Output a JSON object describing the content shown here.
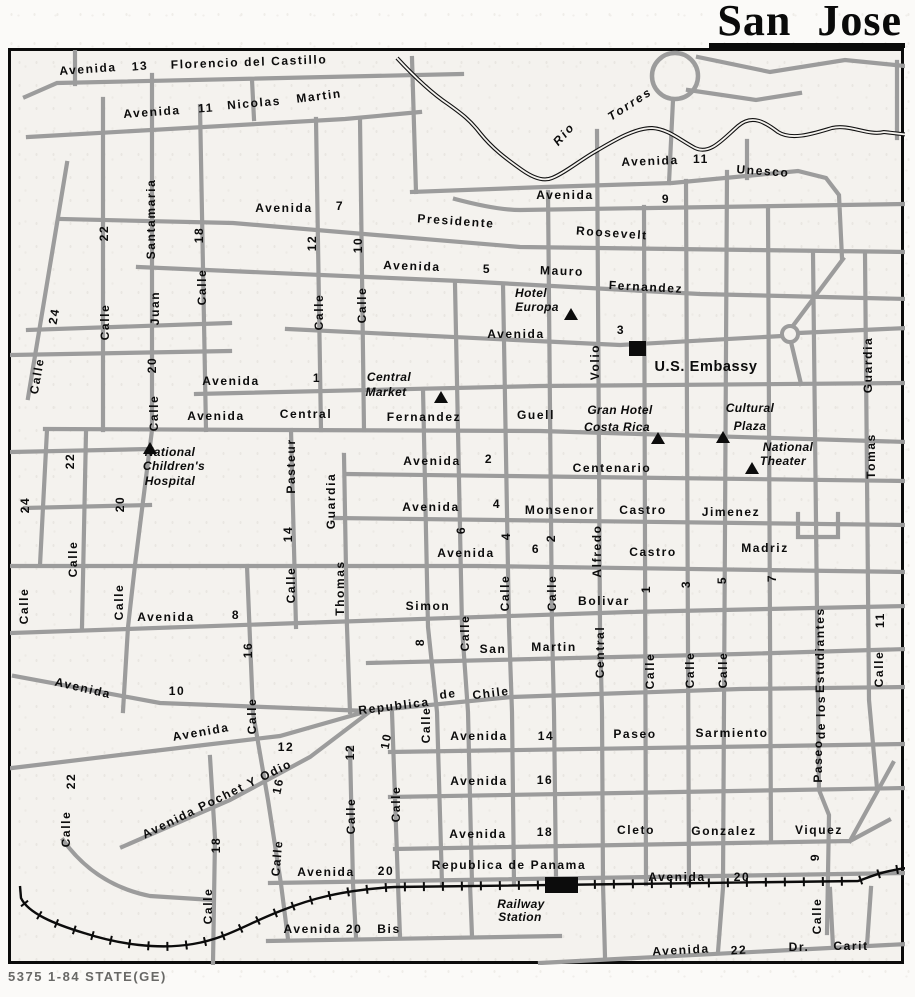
{
  "title": "San Jose",
  "caption": "5375 1-84 STATE(GE)",
  "colors": {
    "road": "#9c9c9c",
    "paper": "#f4f2ee",
    "ink": "#0c0c0c"
  },
  "map": {
    "labels": [
      {
        "t": "Avenida",
        "x": 88,
        "y": 69,
        "r": -4
      },
      {
        "t": "13",
        "x": 140,
        "y": 66,
        "r": -4
      },
      {
        "t": "Florencio del Castillo",
        "x": 249,
        "y": 62,
        "r": -2
      },
      {
        "t": "Avenida",
        "x": 152,
        "y": 112,
        "r": -4
      },
      {
        "t": "11",
        "x": 206,
        "y": 108,
        "r": -4
      },
      {
        "t": "Nicolas",
        "x": 254,
        "y": 103,
        "r": -5
      },
      {
        "t": "Martin",
        "x": 319,
        "y": 96,
        "r": -7
      },
      {
        "t": "Avenida",
        "x": 284,
        "y": 208
      },
      {
        "t": "7",
        "x": 340,
        "y": 206
      },
      {
        "t": "Presidente",
        "x": 456,
        "y": 221,
        "r": 4
      },
      {
        "t": "Roosevelt",
        "x": 612,
        "y": 233,
        "r": 4
      },
      {
        "t": "Avenida",
        "x": 412,
        "y": 266,
        "r": 2
      },
      {
        "t": "5",
        "x": 487,
        "y": 269
      },
      {
        "t": "Mauro",
        "x": 562,
        "y": 271,
        "r": 2
      },
      {
        "t": "Fernandez",
        "x": 646,
        "y": 287,
        "r": 3
      },
      {
        "t": "Avenida",
        "x": 516,
        "y": 334
      },
      {
        "t": "3",
        "x": 621,
        "y": 330
      },
      {
        "t": "Avenida",
        "x": 565,
        "y": 195
      },
      {
        "t": "9",
        "x": 666,
        "y": 199
      },
      {
        "t": "Avenida",
        "x": 650,
        "y": 161,
        "r": -2
      },
      {
        "t": "11",
        "x": 701,
        "y": 159
      },
      {
        "t": "Unesco",
        "x": 763,
        "y": 171,
        "r": 4
      },
      {
        "t": "U.S. Embassy",
        "x": 706,
        "y": 367,
        "k": "emb"
      },
      {
        "t": "Avenida",
        "x": 231,
        "y": 381
      },
      {
        "t": "1",
        "x": 317,
        "y": 378
      },
      {
        "t": "Avenida",
        "x": 216,
        "y": 416
      },
      {
        "t": "Central",
        "x": 306,
        "y": 414
      },
      {
        "t": "Fernandez",
        "x": 424,
        "y": 417
      },
      {
        "t": "Guell",
        "x": 536,
        "y": 415
      },
      {
        "t": "Avenida",
        "x": 432,
        "y": 461
      },
      {
        "t": "2",
        "x": 489,
        "y": 459
      },
      {
        "t": "Centenario",
        "x": 612,
        "y": 468
      },
      {
        "t": "Avenida",
        "x": 431,
        "y": 507
      },
      {
        "t": "4",
        "x": 497,
        "y": 504
      },
      {
        "t": "Monsenor",
        "x": 560,
        "y": 510
      },
      {
        "t": "Castro",
        "x": 643,
        "y": 510
      },
      {
        "t": "Jimenez",
        "x": 731,
        "y": 512
      },
      {
        "t": "Avenida",
        "x": 466,
        "y": 553
      },
      {
        "t": "6",
        "x": 536,
        "y": 549
      },
      {
        "t": "Castro",
        "x": 653,
        "y": 552
      },
      {
        "t": "Madriz",
        "x": 765,
        "y": 548
      },
      {
        "t": "Avenida",
        "x": 166,
        "y": 617
      },
      {
        "t": "8",
        "x": 236,
        "y": 615
      },
      {
        "t": "Simon",
        "x": 428,
        "y": 606
      },
      {
        "t": "Bolivar",
        "x": 604,
        "y": 601
      },
      {
        "t": "San",
        "x": 493,
        "y": 649
      },
      {
        "t": "Martin",
        "x": 554,
        "y": 647
      },
      {
        "t": "Avenida",
        "x": 83,
        "y": 688,
        "r": 13
      },
      {
        "t": "10",
        "x": 177,
        "y": 691
      },
      {
        "t": "Republica",
        "x": 394,
        "y": 706,
        "r": -7
      },
      {
        "t": "de",
        "x": 448,
        "y": 694,
        "r": -7
      },
      {
        "t": "Chile",
        "x": 491,
        "y": 693,
        "r": -7
      },
      {
        "t": "Avenida",
        "x": 201,
        "y": 732,
        "r": -10
      },
      {
        "t": "12",
        "x": 286,
        "y": 747
      },
      {
        "t": "Avenida Pochet Y Odio",
        "x": 217,
        "y": 799,
        "r": -26
      },
      {
        "t": "Avenida",
        "x": 479,
        "y": 736
      },
      {
        "t": "14",
        "x": 546,
        "y": 736
      },
      {
        "t": "Paseo",
        "x": 635,
        "y": 734
      },
      {
        "t": "Sarmiento",
        "x": 732,
        "y": 733
      },
      {
        "t": "Avenida",
        "x": 479,
        "y": 781
      },
      {
        "t": "16",
        "x": 545,
        "y": 780
      },
      {
        "t": "Avenida",
        "x": 478,
        "y": 834
      },
      {
        "t": "18",
        "x": 545,
        "y": 832
      },
      {
        "t": "Cleto",
        "x": 636,
        "y": 830
      },
      {
        "t": "Gonzalez",
        "x": 724,
        "y": 831
      },
      {
        "t": "Viquez",
        "x": 819,
        "y": 830
      },
      {
        "t": "Republica de Panama",
        "x": 509,
        "y": 865
      },
      {
        "t": "Avenida",
        "x": 326,
        "y": 872
      },
      {
        "t": "20",
        "x": 386,
        "y": 871
      },
      {
        "t": "Avenida",
        "x": 677,
        "y": 877
      },
      {
        "t": "20",
        "x": 742,
        "y": 877
      },
      {
        "t": "Avenida 20",
        "x": 323,
        "y": 929
      },
      {
        "t": "Bis",
        "x": 389,
        "y": 929
      },
      {
        "t": "Avenida",
        "x": 681,
        "y": 950,
        "r": -3
      },
      {
        "t": "22",
        "x": 739,
        "y": 950,
        "r": -3
      },
      {
        "t": "Dr.",
        "x": 799,
        "y": 947
      },
      {
        "t": "Carit",
        "x": 851,
        "y": 946
      },
      {
        "t": "Santamaria",
        "x": 151,
        "y": 219,
        "r": -90
      },
      {
        "t": "Juan",
        "x": 155,
        "y": 308,
        "r": -90
      },
      {
        "t": "22",
        "x": 104,
        "y": 233,
        "r": -90
      },
      {
        "t": "Calle",
        "x": 105,
        "y": 322,
        "r": -90
      },
      {
        "t": "24",
        "x": 54,
        "y": 316,
        "r": -80
      },
      {
        "t": "Calle",
        "x": 37,
        "y": 376,
        "r": -80
      },
      {
        "t": "18",
        "x": 199,
        "y": 235,
        "r": -90
      },
      {
        "t": "Calle",
        "x": 202,
        "y": 287,
        "r": -90
      },
      {
        "t": "20",
        "x": 152,
        "y": 365,
        "r": -90
      },
      {
        "t": "Calle",
        "x": 154,
        "y": 413,
        "r": -90
      },
      {
        "t": "12",
        "x": 312,
        "y": 243,
        "r": -90
      },
      {
        "t": "Calle",
        "x": 319,
        "y": 312,
        "r": -90
      },
      {
        "t": "10",
        "x": 358,
        "y": 245,
        "r": -90
      },
      {
        "t": "Calle",
        "x": 362,
        "y": 305,
        "r": -90
      },
      {
        "t": "Volio",
        "x": 595,
        "y": 362,
        "r": -90
      },
      {
        "t": "Alfredo",
        "x": 597,
        "y": 551,
        "r": -90
      },
      {
        "t": "Central",
        "x": 600,
        "y": 652,
        "r": -90
      },
      {
        "t": "Guardia",
        "x": 868,
        "y": 365,
        "r": -90
      },
      {
        "t": "Tomas",
        "x": 871,
        "y": 456,
        "r": -90
      },
      {
        "t": "Pasteur",
        "x": 291,
        "y": 466,
        "r": -90
      },
      {
        "t": "14",
        "x": 288,
        "y": 534,
        "r": -90
      },
      {
        "t": "Calle",
        "x": 291,
        "y": 585,
        "r": -90
      },
      {
        "t": "Guardia",
        "x": 331,
        "y": 501,
        "r": -90
      },
      {
        "t": "Thomas",
        "x": 340,
        "y": 588,
        "r": -90
      },
      {
        "t": "24",
        "x": 25,
        "y": 505,
        "r": -90
      },
      {
        "t": "Calle",
        "x": 24,
        "y": 606,
        "r": -90
      },
      {
        "t": "22",
        "x": 70,
        "y": 461,
        "r": -90
      },
      {
        "t": "Calle",
        "x": 73,
        "y": 559,
        "r": -90
      },
      {
        "t": "20",
        "x": 120,
        "y": 504,
        "r": -90
      },
      {
        "t": "Calle",
        "x": 119,
        "y": 602,
        "r": -90
      },
      {
        "t": "6",
        "x": 461,
        "y": 530,
        "r": -90
      },
      {
        "t": "4",
        "x": 506,
        "y": 536,
        "r": -90
      },
      {
        "t": "2",
        "x": 551,
        "y": 538,
        "r": -90
      },
      {
        "t": "Calle",
        "x": 505,
        "y": 593,
        "r": -90
      },
      {
        "t": "Calle",
        "x": 552,
        "y": 593,
        "r": -90
      },
      {
        "t": "8",
        "x": 420,
        "y": 642,
        "r": -90
      },
      {
        "t": "Calle",
        "x": 465,
        "y": 633,
        "r": -90
      },
      {
        "t": "1",
        "x": 646,
        "y": 589,
        "r": -90
      },
      {
        "t": "3",
        "x": 686,
        "y": 584,
        "r": -90
      },
      {
        "t": "5",
        "x": 722,
        "y": 580,
        "r": -90
      },
      {
        "t": "7",
        "x": 772,
        "y": 578,
        "r": -90
      },
      {
        "t": "Calle",
        "x": 650,
        "y": 671,
        "r": -90
      },
      {
        "t": "Calle",
        "x": 690,
        "y": 670,
        "r": -90
      },
      {
        "t": "Calle",
        "x": 723,
        "y": 670,
        "r": -90
      },
      {
        "t": "16",
        "x": 248,
        "y": 650,
        "r": -90
      },
      {
        "t": "Calle",
        "x": 252,
        "y": 716,
        "r": -90
      },
      {
        "t": "16",
        "x": 278,
        "y": 786,
        "r": -78
      },
      {
        "t": "Calle",
        "x": 277,
        "y": 858,
        "r": -85
      },
      {
        "t": "22",
        "x": 71,
        "y": 781,
        "r": -90
      },
      {
        "t": "Calle",
        "x": 66,
        "y": 829,
        "r": -90
      },
      {
        "t": "12",
        "x": 350,
        "y": 752,
        "r": -90
      },
      {
        "t": "Calle",
        "x": 351,
        "y": 816,
        "r": -90
      },
      {
        "t": "10",
        "x": 386,
        "y": 741,
        "r": -80
      },
      {
        "t": "Calle",
        "x": 396,
        "y": 804,
        "r": -90
      },
      {
        "t": "Calle",
        "x": 426,
        "y": 725,
        "r": -90
      },
      {
        "t": "18",
        "x": 216,
        "y": 845,
        "r": -90
      },
      {
        "t": "Calle",
        "x": 208,
        "y": 906,
        "r": -90
      },
      {
        "t": "9",
        "x": 815,
        "y": 857,
        "r": -90
      },
      {
        "t": "Calle",
        "x": 817,
        "y": 916,
        "r": -90
      },
      {
        "t": "11",
        "x": 880,
        "y": 620,
        "r": -90
      },
      {
        "t": "Calle",
        "x": 879,
        "y": 669,
        "r": -90
      },
      {
        "t": "Estudiantes",
        "x": 820,
        "y": 650,
        "r": -90
      },
      {
        "t": "de los",
        "x": 821,
        "y": 717,
        "r": -90
      },
      {
        "t": "Paseo",
        "x": 818,
        "y": 761,
        "r": -90
      },
      {
        "t": "Rio",
        "x": 564,
        "y": 134,
        "r": -48,
        "k": "riv"
      },
      {
        "t": "Torres",
        "x": 630,
        "y": 104,
        "r": -33,
        "k": "riv"
      },
      {
        "t": "Hotel",
        "x": 531,
        "y": 293,
        "k": "poi"
      },
      {
        "t": "Europa",
        "x": 537,
        "y": 307,
        "k": "poi"
      },
      {
        "t": "Central",
        "x": 389,
        "y": 377,
        "k": "poi"
      },
      {
        "t": "Market",
        "x": 386,
        "y": 392,
        "k": "poi"
      },
      {
        "t": "National",
        "x": 170,
        "y": 452,
        "k": "poi"
      },
      {
        "t": "Children's",
        "x": 174,
        "y": 466,
        "k": "poi"
      },
      {
        "t": "Hospital",
        "x": 170,
        "y": 481,
        "k": "poi"
      },
      {
        "t": "Gran Hotel",
        "x": 620,
        "y": 410,
        "k": "poi"
      },
      {
        "t": "Costa Rica",
        "x": 617,
        "y": 427,
        "k": "poi"
      },
      {
        "t": "Cultural",
        "x": 750,
        "y": 408,
        "k": "poi"
      },
      {
        "t": "Plaza",
        "x": 750,
        "y": 426,
        "k": "poi"
      },
      {
        "t": "National",
        "x": 788,
        "y": 447,
        "k": "poi"
      },
      {
        "t": "Theater",
        "x": 783,
        "y": 461,
        "k": "poi"
      },
      {
        "t": "Railway",
        "x": 521,
        "y": 904,
        "k": "poi"
      },
      {
        "t": "Station",
        "x": 520,
        "y": 917,
        "k": "poi"
      }
    ]
  }
}
